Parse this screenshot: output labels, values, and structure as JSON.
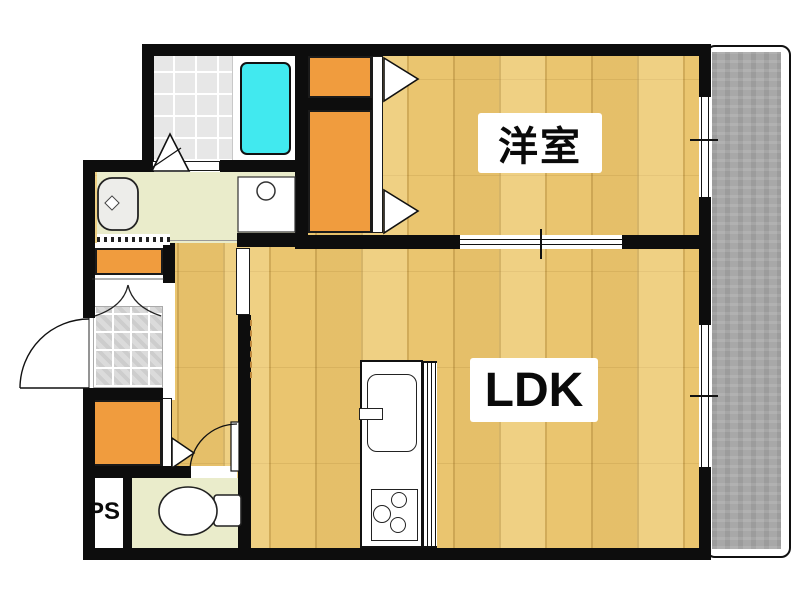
{
  "rooms": {
    "western_room": {
      "label": "洋室"
    },
    "ldk": {
      "label": "LDK"
    },
    "pipe_space": {
      "label": "PS"
    }
  },
  "fixtures": [
    "bathtub",
    "shower-tile-floor",
    "washbasin",
    "washing-machine-pan",
    "toilet",
    "kitchen-sink",
    "gas-stove",
    "kitchen-counter",
    "balcony",
    "entrance-door-swing",
    "shoe-cabinet",
    "closet",
    "folding-doors",
    "sliding-door",
    "windows",
    "genkan-tile"
  ],
  "colors": {
    "wall": "#0d0d0d",
    "wood": "#eac56f",
    "orange": "#f09c3e",
    "wet": "#eaeccb",
    "tile": "#e7e7e7",
    "genkan": "#d8d8d8",
    "balcony": "#a8a8a8",
    "bathtub": "#41e9ef"
  }
}
